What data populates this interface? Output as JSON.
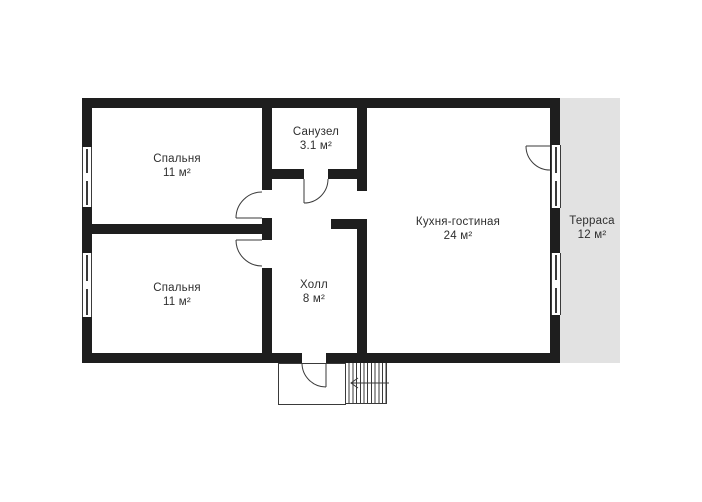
{
  "colors": {
    "wall": "#1e1e1e",
    "line": "#3a3a3a",
    "terrace_fill": "#e2e2e2",
    "text": "#2e2e2e",
    "background": "#ffffff"
  },
  "plan": {
    "type": "floor-plan",
    "rooms": [
      {
        "key": "bedroom-top",
        "name": "Спальня",
        "area": "11 м²"
      },
      {
        "key": "bedroom-bottom",
        "name": "Спальня",
        "area": "11 м²"
      },
      {
        "key": "bathroom",
        "name": "Санузел",
        "area": "3.1 м²"
      },
      {
        "key": "hall",
        "name": "Холл",
        "area": "8 м²"
      },
      {
        "key": "kitchen-living",
        "name": "Кухня-гостиная",
        "area": "24 м²"
      },
      {
        "key": "terrace",
        "name": "Терраса",
        "area": "12 м²"
      }
    ]
  }
}
